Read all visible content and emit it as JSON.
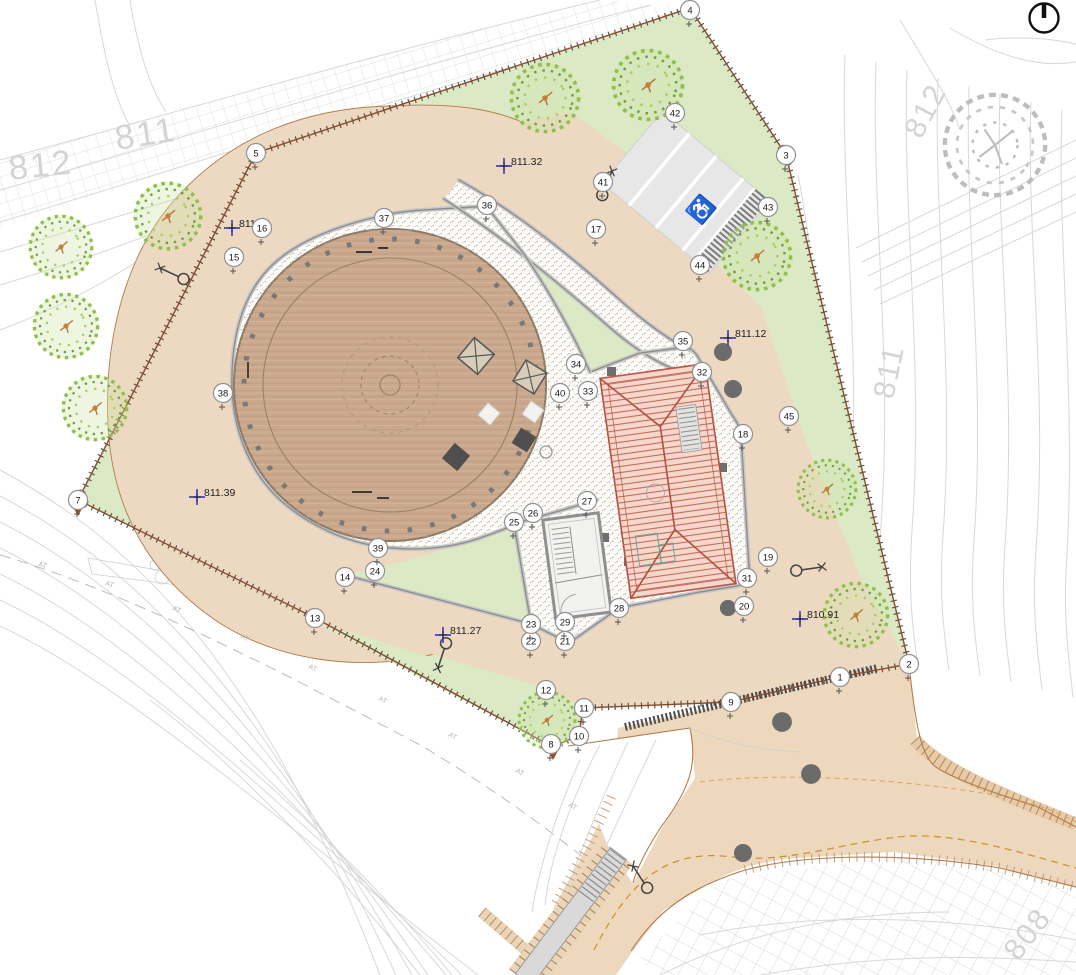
{
  "document": {
    "type": "architectural landscape site plan",
    "description": "Site plan with circular timber deck, spiral gravel path, pavilion with hipped roof, service building, parking lot and access road"
  },
  "colors": {
    "grass": "#dbeac5",
    "path_beige": "#edd9c1",
    "road_beige": "#eed8bd",
    "gravel": "#fcfbf8",
    "deck_timber": "#c9a88d",
    "roof_fill": "#f3d8cd",
    "roof_line": "#b2503e",
    "boundary_brown": "#8a4b2a",
    "elevation_blue": "#4343b5",
    "contour_gray": "#d8d8d8",
    "centerline_yellow": "#c9962e"
  },
  "north_arrow": {
    "name": "north-indicator"
  },
  "parking": {
    "stalls": 4,
    "disabled_symbol": "♿"
  },
  "contour_labels": [
    {
      "t": "811",
      "x": 117,
      "y": 150,
      "rot": -9,
      "s": 1.15
    },
    {
      "t": "812",
      "x": 10,
      "y": 180,
      "rot": -6,
      "s": 1.15
    },
    {
      "t": "812",
      "x": 921,
      "y": 140,
      "rot": -62,
      "s": 1
    },
    {
      "t": "811",
      "x": 893,
      "y": 400,
      "rot": -78,
      "s": 1
    },
    {
      "t": "808",
      "x": 1018,
      "y": 962,
      "rot": -52,
      "s": 1
    }
  ],
  "spot_elevations": [
    {
      "t": "811.49",
      "x": 232,
      "y": 228
    },
    {
      "t": "811.32",
      "x": 504,
      "y": 166
    },
    {
      "t": "811.12",
      "x": 728,
      "y": 338
    },
    {
      "t": "811.39",
      "x": 197,
      "y": 497
    },
    {
      "t": "811.27",
      "x": 443,
      "y": 635
    },
    {
      "t": "810.91",
      "x": 800,
      "y": 619
    }
  ],
  "boundary_markers": [
    {
      "t": "1",
      "x": 840,
      "y": 677
    },
    {
      "t": "2",
      "x": 909,
      "y": 664
    },
    {
      "t": "3",
      "x": 786,
      "y": 155
    },
    {
      "t": "4",
      "x": 690,
      "y": 10
    },
    {
      "t": "5",
      "x": 256,
      "y": 153
    },
    {
      "t": "7",
      "x": 78,
      "y": 500
    },
    {
      "t": "8",
      "x": 551,
      "y": 744
    },
    {
      "t": "9",
      "x": 731,
      "y": 702
    },
    {
      "t": "10",
      "x": 579,
      "y": 736
    },
    {
      "t": "11",
      "x": 584,
      "y": 708
    },
    {
      "t": "12",
      "x": 546,
      "y": 690
    },
    {
      "t": "13",
      "x": 315,
      "y": 618
    },
    {
      "t": "14",
      "x": 345,
      "y": 577
    },
    {
      "t": "15",
      "x": 234,
      "y": 257
    },
    {
      "t": "16",
      "x": 262,
      "y": 228
    },
    {
      "t": "17",
      "x": 596,
      "y": 229
    },
    {
      "t": "18",
      "x": 743,
      "y": 434
    },
    {
      "t": "19",
      "x": 768,
      "y": 557
    },
    {
      "t": "20",
      "x": 744,
      "y": 606
    },
    {
      "t": "21",
      "x": 565,
      "y": 641
    },
    {
      "t": "22",
      "x": 531,
      "y": 641
    },
    {
      "t": "23",
      "x": 531,
      "y": 624
    },
    {
      "t": "24",
      "x": 375,
      "y": 571
    },
    {
      "t": "25",
      "x": 514,
      "y": 522
    },
    {
      "t": "26",
      "x": 533,
      "y": 513
    },
    {
      "t": "27",
      "x": 587,
      "y": 501
    },
    {
      "t": "28",
      "x": 619,
      "y": 608
    },
    {
      "t": "29",
      "x": 565,
      "y": 622
    },
    {
      "t": "31",
      "x": 747,
      "y": 578
    },
    {
      "t": "32",
      "x": 702,
      "y": 372
    },
    {
      "t": "33",
      "x": 588,
      "y": 391
    },
    {
      "t": "34",
      "x": 576,
      "y": 364
    },
    {
      "t": "35",
      "x": 683,
      "y": 341
    },
    {
      "t": "36",
      "x": 487,
      "y": 205
    },
    {
      "t": "37",
      "x": 384,
      "y": 218
    },
    {
      "t": "38",
      "x": 223,
      "y": 393
    },
    {
      "t": "39",
      "x": 378,
      "y": 548
    },
    {
      "t": "40",
      "x": 560,
      "y": 393
    },
    {
      "t": "41",
      "x": 603,
      "y": 182
    },
    {
      "t": "42",
      "x": 675,
      "y": 113
    },
    {
      "t": "43",
      "x": 768,
      "y": 207
    },
    {
      "t": "44",
      "x": 700,
      "y": 265
    },
    {
      "t": "45",
      "x": 789,
      "y": 416
    }
  ],
  "trees_proposed": [
    {
      "x": 61,
      "y": 247,
      "s": 1.1
    },
    {
      "x": 168,
      "y": 216,
      "s": 1.17
    },
    {
      "x": 66,
      "y": 326,
      "s": 1.13
    },
    {
      "x": 95,
      "y": 408,
      "s": 1.13
    },
    {
      "x": 545,
      "y": 98,
      "s": 1.2
    },
    {
      "x": 648,
      "y": 85,
      "s": 1.23
    },
    {
      "x": 757,
      "y": 256,
      "s": 1.2
    },
    {
      "x": 827,
      "y": 489,
      "s": 1.03
    },
    {
      "x": 856,
      "y": 615,
      "s": 1.13
    },
    {
      "x": 547,
      "y": 720,
      "s": 1.0
    }
  ],
  "trees_existing": [
    {
      "x": 995,
      "y": 145,
      "s": 1.73
    }
  ],
  "tree_trunk_dots": [
    {
      "x": 723,
      "y": 352,
      "s": 1
    },
    {
      "x": 733,
      "y": 389,
      "s": 1
    },
    {
      "x": 728,
      "y": 608,
      "s": 0.9
    },
    {
      "x": 782,
      "y": 722,
      "s": 1.1
    },
    {
      "x": 811,
      "y": 774,
      "s": 1.1
    },
    {
      "x": 743,
      "y": 853,
      "s": 1
    }
  ],
  "street_lamps": [
    {
      "x": 160,
      "y": 268,
      "rot": 25
    },
    {
      "x": 612,
      "y": 171,
      "rot": 112
    },
    {
      "x": 438,
      "y": 668,
      "rot": -72
    },
    {
      "x": 822,
      "y": 567,
      "rot": 172
    },
    {
      "x": 633,
      "y": 866,
      "rot": 57
    }
  ],
  "at_labels": [
    {
      "t": "AT",
      "x": 38,
      "y": 566,
      "rot": 16
    },
    {
      "t": "AT",
      "x": 105,
      "y": 585,
      "rot": 18
    },
    {
      "t": "AT",
      "x": 172,
      "y": 610,
      "rot": 22
    },
    {
      "t": "AT",
      "x": 240,
      "y": 638,
      "rot": 24
    },
    {
      "t": "AT",
      "x": 308,
      "y": 668,
      "rot": 26
    },
    {
      "t": "AT",
      "x": 378,
      "y": 700,
      "rot": 27
    },
    {
      "t": "AT",
      "x": 448,
      "y": 736,
      "rot": 28
    },
    {
      "t": "AT",
      "x": 515,
      "y": 772,
      "rot": 29
    },
    {
      "t": "AT",
      "x": 568,
      "y": 806,
      "rot": 30
    }
  ]
}
